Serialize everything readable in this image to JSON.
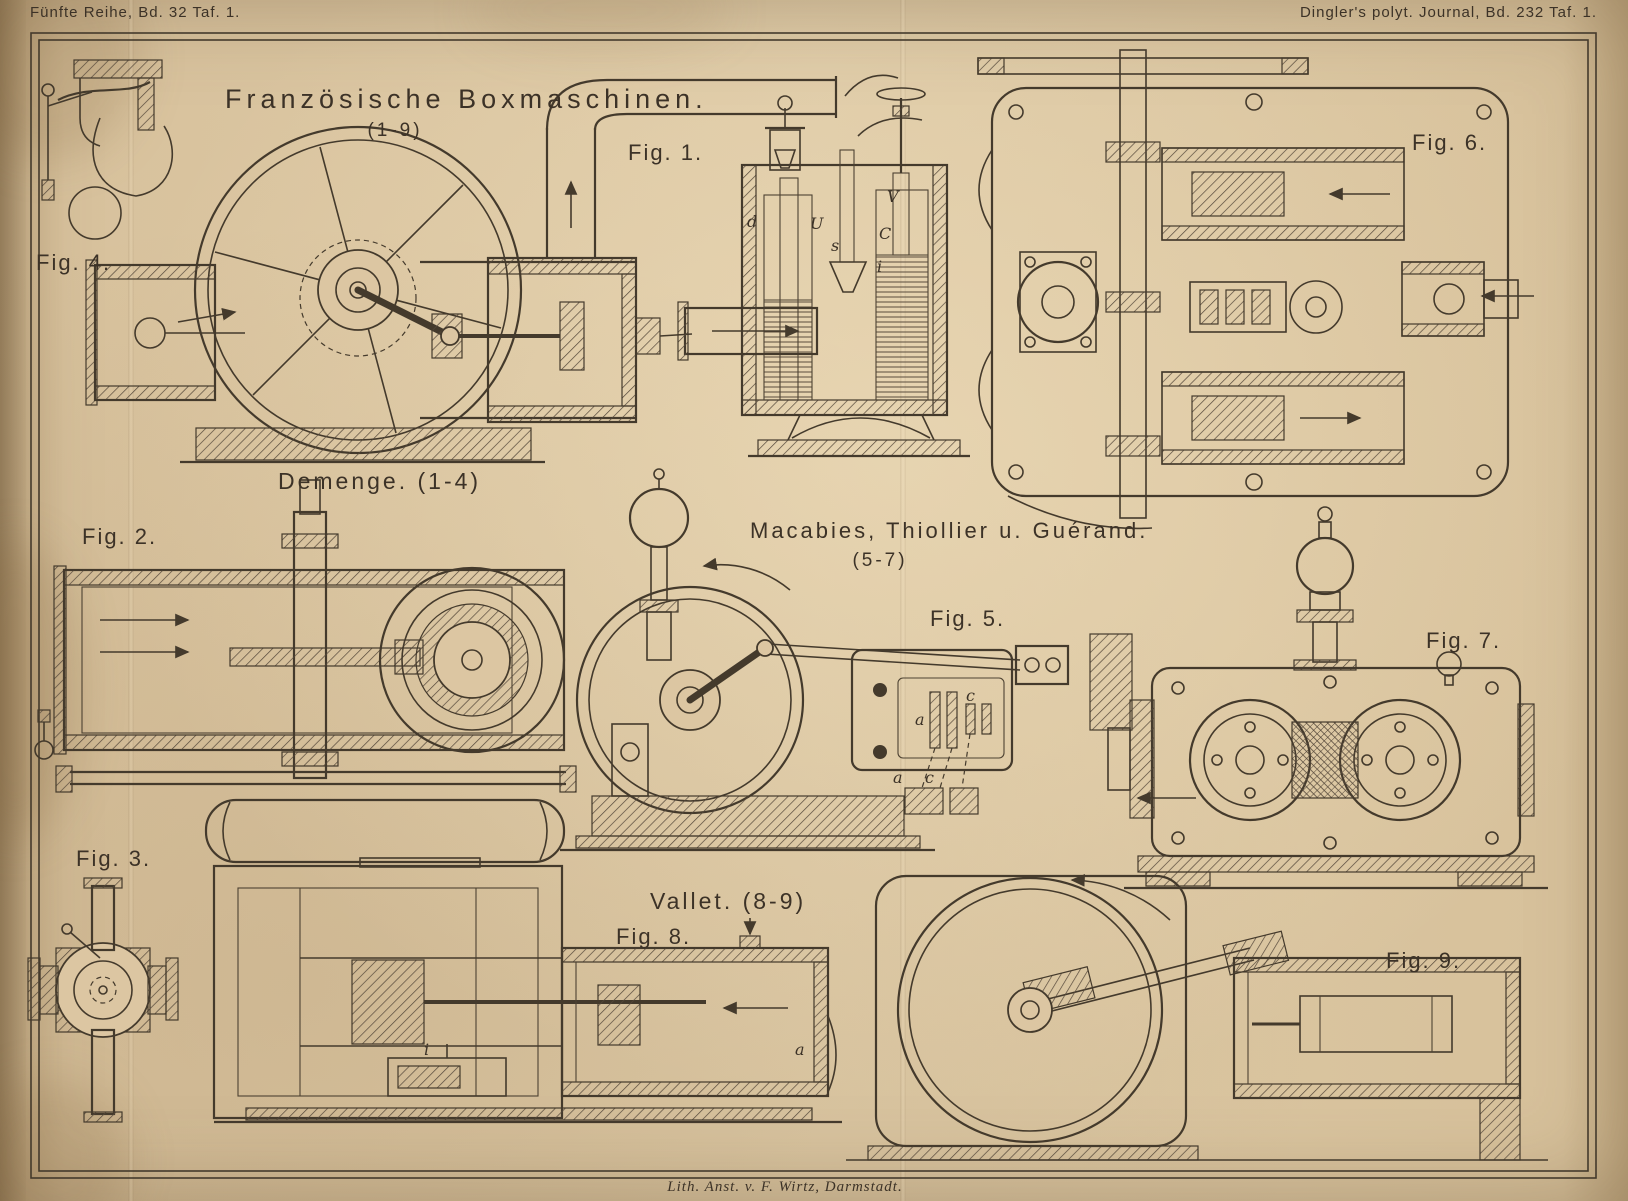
{
  "colors": {
    "paper": "#dcc6a2",
    "ink": "#443a2c"
  },
  "plate": {
    "header_left": "Fünfte Reihe, Bd. 32 Taf. 1.",
    "header_right": "Dingler's polyt. Journal, Bd. 232 Taf. 1.",
    "title": "Französische Boxmaschinen.",
    "title_range": "(1-9)",
    "footer": "Lith. Anst. v. F. Wirtz, Darmstadt."
  },
  "sections": {
    "demenge": {
      "name": "Demenge.",
      "range": "(1-4)"
    },
    "macabies": {
      "name": "Macabies, Thiollier u. Guérand.",
      "range": "(5-7)"
    },
    "vallet": {
      "name": "Vallet.",
      "range": "(8-9)"
    }
  },
  "figures": {
    "fig1": "Fig. 1.",
    "fig2": "Fig. 2.",
    "fig3": "Fig. 3.",
    "fig4": "Fig. 4.",
    "fig5": "Fig. 5.",
    "fig6": "Fig. 6.",
    "fig7": "Fig. 7.",
    "fig8": "Fig. 8.",
    "fig9": "Fig. 9."
  },
  "annotations": {
    "fig1": {
      "d": "d",
      "u": "U",
      "s": "s",
      "c": "C",
      "i": "i",
      "v": "V"
    },
    "fig5": {
      "a1": "a",
      "c1": "c",
      "a2": "a",
      "c2": "c"
    },
    "fig8": {
      "i": "i",
      "a": "a"
    }
  }
}
